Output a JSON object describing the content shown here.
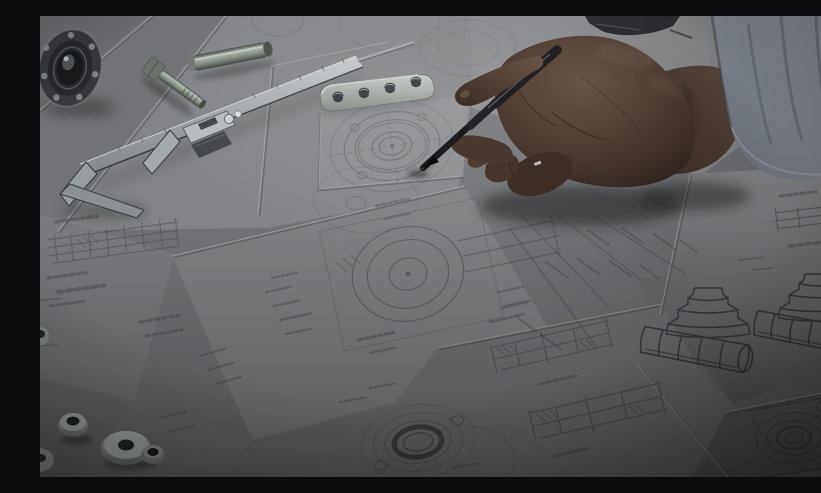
{
  "image": {
    "domain": "Natural-Image",
    "type": "photograph",
    "description": "Engineer technician drafting mechanical part drawings: a hand holding a black pen over technical blueprint sheets on a desk, with a vernier caliper, ball bearing, dowel pin, hex bolt, drilled link plate and washers, darkened by a photographic overlay",
    "width_px": 821,
    "height_px": 461
  },
  "scene": {
    "setting": "drafting desk covered with overlapping technical drawing sheets viewed at an angle",
    "lighting": "soft daylight from the upper right, dark tint overlay with vignetted corners",
    "objects": [
      {
        "id": "ball-bearing",
        "label": "Ball bearing",
        "position": "top-left corner"
      },
      {
        "id": "vernier-caliper",
        "label": "Vernier caliper",
        "position": "upper left, lying diagonally"
      },
      {
        "id": "dowel-pin",
        "label": "Steel dowel pin",
        "position": "top, above the caliper beam"
      },
      {
        "id": "hex-bolt",
        "label": "Hex bolt",
        "position": "top, beside the caliper beam"
      },
      {
        "id": "link-plate",
        "label": "Drilled steel link plate with four holes",
        "position": "top center"
      },
      {
        "id": "divider-tool",
        "label": "Drafting tool partially visible",
        "position": "top edge, center-right"
      },
      {
        "id": "hand",
        "label": "Engineer's hand holding a pen",
        "position": "center right"
      },
      {
        "id": "pen",
        "label": "Black drafting pen touching the drawing",
        "position": "center"
      },
      {
        "id": "sleeve",
        "label": "Light gray shirt sleeve",
        "position": "top-right corner"
      },
      {
        "id": "flange-drawing-top",
        "label": "Concentric-circle flange drawing",
        "position": "center, under the pen tip"
      },
      {
        "id": "assembly-drawing",
        "label": "Dimensioned assembly drawing with circular part",
        "position": "center"
      },
      {
        "id": "shaft-section-drawings",
        "label": "Stepped shaft section drawings",
        "position": "bottom center"
      },
      {
        "id": "flange-drawing-bottom",
        "label": "Flange drawing with dark bore ring",
        "position": "bottom center-left"
      },
      {
        "id": "shaft-side-drawing",
        "label": "Small dimensioned shaft drawing",
        "position": "right, below the sleeve"
      },
      {
        "id": "square-flange-drawing",
        "label": "Square flange plate drawing",
        "position": "bottom right"
      },
      {
        "id": "isometric-sketches",
        "label": "Two isometric sketches of stepped fittings",
        "position": "bottom right"
      },
      {
        "id": "washers",
        "label": "Washers, spacer and bushings",
        "position": "bottom-left corner"
      }
    ],
    "palette": {
      "paper_bright": "#8f9092",
      "paper_mid": "#7a7b7e",
      "paper_dark": "#606164",
      "desk_shadow": "#4a4b4e",
      "pencil_line": "#55565a",
      "metal_light": "#c3c8ca",
      "metal_mid": "#9aa0a2",
      "metal_dark": "#3c4042",
      "steel_green": "#848d83",
      "skin_light": "#6e584b",
      "skin_dark": "#342923",
      "pen_black": "#17171a",
      "sleeve_gray": "#8e949c",
      "overlay_black": "#000000"
    }
  }
}
